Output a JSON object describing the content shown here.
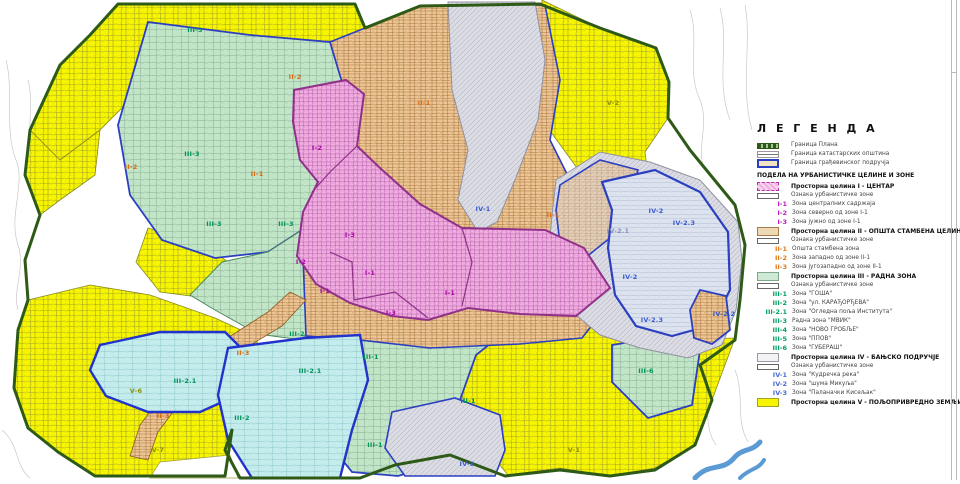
{
  "colors": {
    "magenta": "#b000b0",
    "orange": "#d86a10",
    "green": "#00935a",
    "blue": "#3a5bd0",
    "olive": "#8f8f00",
    "grayblue": "#8090b8",
    "plan_boundary_green": "#2d5a17",
    "construction_boundary_blue": "#2b3fc0",
    "agricultural_yellow": "#f7f500",
    "work_zone_green": "#c2e5c8",
    "housing_tan": "#ecc795",
    "center_pink": "#efaede",
    "spa_gray": "#dcdde4",
    "subzone_cyan": "#c4ecec"
  },
  "legend": {
    "title": "Л Е Г Е Н Д А",
    "boundary_items": [
      {
        "label": "Граница Плана",
        "swatch": "plan"
      },
      {
        "label": "Граница катастарских општина",
        "swatch": "cadastral"
      },
      {
        "label": "Граница грађевинског подручја",
        "swatch": "constr"
      }
    ],
    "division_title": "ПОДЕЛА НА УРБАНИСТИЧКЕ ЦЕЛИНЕ И ЗОНЕ",
    "sections": [
      {
        "header": "Просторна целина I - ЦЕНТАР",
        "swatch": "c1",
        "marker_label": "Ознака урбанистичке зоне",
        "code_color": "#c020c0",
        "zones": [
          {
            "code": "I-1",
            "label": "Зона централних садржаја"
          },
          {
            "code": "I-2",
            "label": "Зона северно од зоне I-1"
          },
          {
            "code": "I-3",
            "label": "Зона јужно од зоне I-1"
          }
        ]
      },
      {
        "header": "Просторна целина II - ОПШТА СТАМБЕНА ЦЕЛИНА",
        "swatch": "c2",
        "marker_label": "Ознака урбанистичке зоне",
        "code_color": "#e07818",
        "zones": [
          {
            "code": "II-1",
            "label": "Општа стамбена зона"
          },
          {
            "code": "II-2",
            "label": "Зона западно од зоне II-1"
          },
          {
            "code": "II-3",
            "label": "Зона југозападно од зоне II-1"
          }
        ]
      },
      {
        "header": "Просторна целина III - РАДНА ЗОНА",
        "swatch": "c3",
        "marker_label": "Ознака урбанистичке зоне",
        "code_color": "#00a060",
        "zones": [
          {
            "code": "III-1",
            "label": "Зона \"ГОША\""
          },
          {
            "code": "III-2",
            "label": "Зона \"ул. КАРАЂОРЂЕВА\""
          },
          {
            "code": "III-2.1",
            "label": "Зона \"Огледна поља Института\""
          },
          {
            "code": "III-3",
            "label": "Радна зона \"МВИК\""
          },
          {
            "code": "III-4",
            "label": "Зона \"НОВО ГРОБЉЕ\""
          },
          {
            "code": "III-5",
            "label": "Зона \"ППОВ\""
          },
          {
            "code": "III-6",
            "label": "Зона \"ГУБЕРАШ\""
          }
        ]
      },
      {
        "header": "Просторна целина IV - БАЊСКО ПОДРУЧЈЕ",
        "swatch": "c4",
        "marker_label": "Ознака урбанистичке зоне",
        "code_color": "#4a6ad0",
        "zones": [
          {
            "code": "IV-1",
            "label": "Зона \"Кудречка река\""
          },
          {
            "code": "IV-2",
            "label": "Зона \"шума Микуља\""
          },
          {
            "code": "IV-3",
            "label": "Зона \"Паланачки Кисељак\""
          }
        ]
      },
      {
        "header": "Просторна целина V - ПОЉОПРИВРЕДНО ЗЕМЉИШТЕ",
        "swatch": "c5",
        "marker_label": null,
        "code_color": "#8f8f00",
        "zones": []
      }
    ]
  },
  "map": {
    "labels": [
      {
        "code": "III-3",
        "x": 195,
        "y": 30,
        "color": "green"
      },
      {
        "code": "II-2",
        "x": 295,
        "y": 77,
        "color": "orange"
      },
      {
        "code": "II-1",
        "x": 424,
        "y": 103,
        "color": "orange"
      },
      {
        "code": "V-2",
        "x": 613,
        "y": 103,
        "color": "olive"
      },
      {
        "code": "I-2",
        "x": 317,
        "y": 148,
        "color": "magenta"
      },
      {
        "code": "III-3",
        "x": 192,
        "y": 154,
        "color": "green"
      },
      {
        "code": "II-2",
        "x": 131,
        "y": 167,
        "color": "orange"
      },
      {
        "code": "II-1",
        "x": 257,
        "y": 174,
        "color": "orange"
      },
      {
        "code": "IV-1",
        "x": 483,
        "y": 209,
        "color": "blue"
      },
      {
        "code": "IV-2",
        "x": 656,
        "y": 211,
        "color": "blue"
      },
      {
        "code": "II-1",
        "x": 553,
        "y": 215,
        "color": "orange"
      },
      {
        "code": "IV-2.3",
        "x": 684,
        "y": 223,
        "color": "blue"
      },
      {
        "code": "III-3",
        "x": 214,
        "y": 224,
        "color": "green"
      },
      {
        "code": "III-3",
        "x": 286,
        "y": 224,
        "color": "green"
      },
      {
        "code": "IV-2.1",
        "x": 618,
        "y": 231,
        "color": "grayblue"
      },
      {
        "code": "I-3",
        "x": 350,
        "y": 235,
        "color": "magenta"
      },
      {
        "code": "I-2",
        "x": 301,
        "y": 262,
        "color": "magenta"
      },
      {
        "code": "I-1",
        "x": 370,
        "y": 273,
        "color": "magenta"
      },
      {
        "code": "IV-2",
        "x": 630,
        "y": 277,
        "color": "blue"
      },
      {
        "code": "I-1",
        "x": 325,
        "y": 291,
        "color": "magenta"
      },
      {
        "code": "I-1",
        "x": 450,
        "y": 293,
        "color": "magenta"
      },
      {
        "code": "I-3",
        "x": 391,
        "y": 313,
        "color": "magenta"
      },
      {
        "code": "IV-2.2",
        "x": 724,
        "y": 314,
        "color": "blue"
      },
      {
        "code": "IV-2.3",
        "x": 652,
        "y": 320,
        "color": "blue"
      },
      {
        "code": "III-2",
        "x": 297,
        "y": 334,
        "color": "green"
      },
      {
        "code": "II-3",
        "x": 243,
        "y": 353,
        "color": "orange"
      },
      {
        "code": "III-1",
        "x": 371,
        "y": 357,
        "color": "green"
      },
      {
        "code": "III-2.1",
        "x": 310,
        "y": 371,
        "color": "green"
      },
      {
        "code": "III-6",
        "x": 646,
        "y": 371,
        "color": "green"
      },
      {
        "code": "III-2.1",
        "x": 185,
        "y": 381,
        "color": "green"
      },
      {
        "code": "V-6",
        "x": 136,
        "y": 391,
        "color": "olive"
      },
      {
        "code": "III-1",
        "x": 468,
        "y": 401,
        "color": "green"
      },
      {
        "code": "II-3",
        "x": 163,
        "y": 416,
        "color": "orange"
      },
      {
        "code": "III-2",
        "x": 242,
        "y": 418,
        "color": "green"
      },
      {
        "code": "III-1",
        "x": 375,
        "y": 445,
        "color": "green"
      },
      {
        "code": "V-1",
        "x": 574,
        "y": 450,
        "color": "olive"
      },
      {
        "code": "V-7",
        "x": 158,
        "y": 450,
        "color": "olive"
      },
      {
        "code": "IV-3",
        "x": 467,
        "y": 464,
        "color": "blue"
      }
    ]
  }
}
